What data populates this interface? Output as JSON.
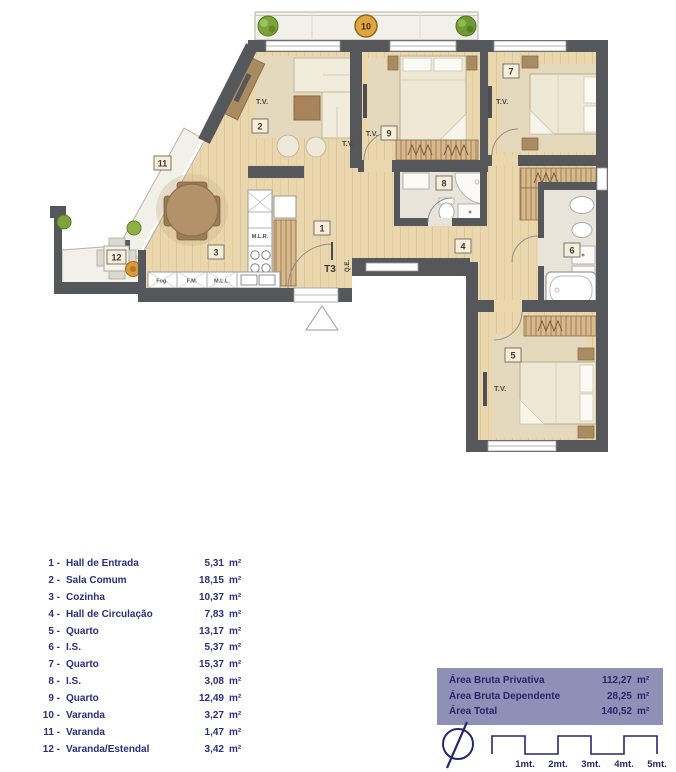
{
  "plan": {
    "unit": "T3",
    "tv": "T.V.",
    "markers": {
      "m1": "1",
      "m2": "2",
      "m3": "3",
      "m4": "4",
      "m5": "5",
      "m6": "6",
      "m7": "7",
      "m8": "8",
      "m9": "9",
      "m10": "10",
      "m11": "11",
      "m12": "12"
    },
    "labels": {
      "mlr": "M.L.R.",
      "fog": "Fog.",
      "fm": "F.M.",
      "mll": "M.L.L.",
      "qe": "Q.E."
    }
  },
  "legend": {
    "rows": [
      {
        "num": "1 -",
        "name": "Hall de Entrada",
        "value": "5,31",
        "unit": "m²"
      },
      {
        "num": "2 -",
        "name": "Sala Comum",
        "value": "18,15",
        "unit": "m²"
      },
      {
        "num": "3 -",
        "name": "Cozinha",
        "value": "10,37",
        "unit": "m²"
      },
      {
        "num": "4 -",
        "name": "Hall de Circulação",
        "value": "7,83",
        "unit": "m²"
      },
      {
        "num": "5 -",
        "name": "Quarto",
        "value": "13,17",
        "unit": "m²"
      },
      {
        "num": "6 -",
        "name": "I.S.",
        "value": "5,37",
        "unit": "m²"
      },
      {
        "num": "7 -",
        "name": "Quarto",
        "value": "15,37",
        "unit": "m²"
      },
      {
        "num": "8 -",
        "name": "I.S.",
        "value": "3,08",
        "unit": "m²"
      },
      {
        "num": "9 -",
        "name": "Quarto",
        "value": "12,49",
        "unit": "m²"
      },
      {
        "num": "10 -",
        "name": "Varanda",
        "value": "3,27",
        "unit": "m²"
      },
      {
        "num": "11 -",
        "name": "Varanda",
        "value": "1,47",
        "unit": "m²"
      },
      {
        "num": "12 -",
        "name": "Varanda/Estendal",
        "value": "3,42",
        "unit": "m²"
      }
    ]
  },
  "areas": {
    "rows": [
      {
        "label": "Área Bruta Privativa",
        "value": "112,27",
        "unit": "m²"
      },
      {
        "label": "Área Bruta Dependente",
        "value": "28,25",
        "unit": "m²"
      },
      {
        "label": "Área Total",
        "value": "140,52",
        "unit": "m²"
      }
    ]
  },
  "scale": {
    "ticks": [
      "1mt.",
      "2mt.",
      "3mt.",
      "4mt.",
      "5mt."
    ]
  },
  "colors": {
    "navy": "#2b2d7e",
    "table_bg": "#8e90b5",
    "wall": "#56575b",
    "wood": "#ebd7ad"
  }
}
